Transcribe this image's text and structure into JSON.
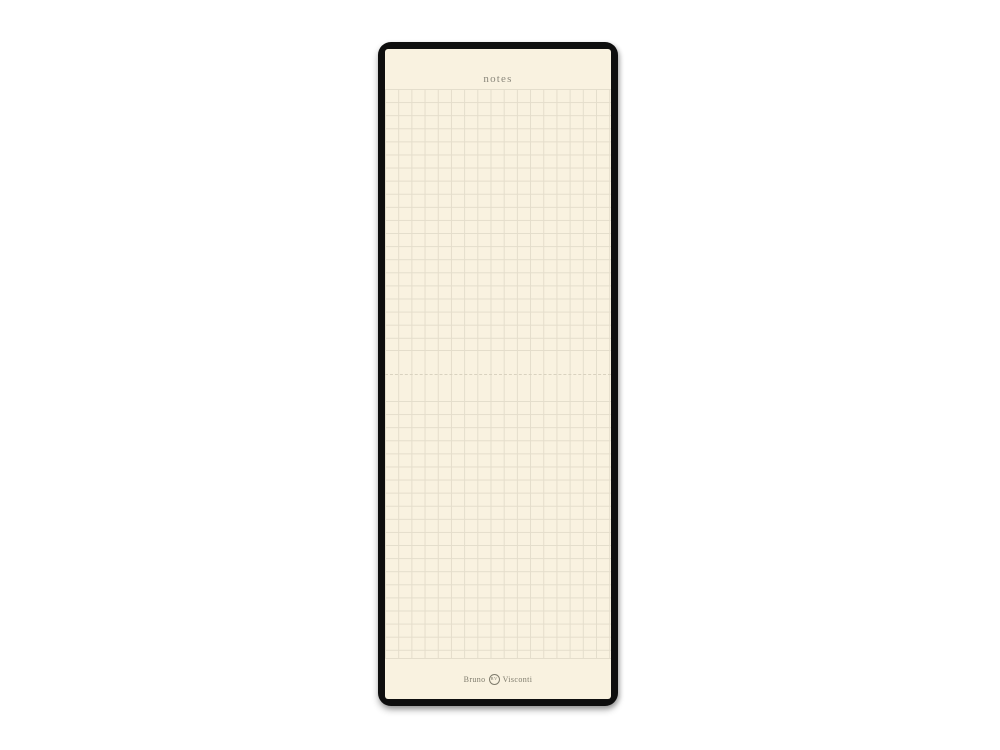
{
  "colors": {
    "page-bg": "#ffffff",
    "cover-black": "#0e0e0e",
    "paper-cream": "#f9f2e0",
    "grid-line": "#e4ddcb",
    "dash-line": "#d9d2bf",
    "notes-text": "#8b887c",
    "brand-text": "#7f7c6d"
  },
  "notepad": {
    "header_label": "notes",
    "paper_style": "squared-grid",
    "brand": {
      "left": "Bruno",
      "right": "Visconti",
      "emblem": "BV"
    }
  }
}
